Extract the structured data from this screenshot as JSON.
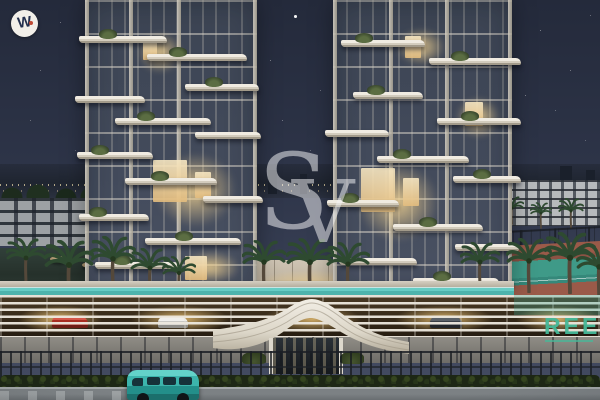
{
  "overlays": {
    "corner_logo": {
      "glyph": "W"
    },
    "center_watermark": {
      "letter_s": "S",
      "letter_v": "V"
    },
    "building_sign": {
      "text": "REEF"
    }
  },
  "palette": {
    "sky_top": "#242a3b",
    "sky_mid": "#2e3549",
    "sky_horizon": "#454d63",
    "glass_dark": "#3c4453",
    "facade_white": "#e6e1d6",
    "warm_light": "#f2d49a",
    "pool_teal": "#66ccc4",
    "pool_teal_deep": "#2f938c",
    "van_teal": "#3cb4ac",
    "court_clay": "#9a5a49",
    "court_teal": "#3f9a88",
    "sign_green": "#45b898",
    "logo_navy": "#24304e",
    "logo_dot_red": "#c04a35",
    "watermark_white": "#f4f4f6"
  }
}
